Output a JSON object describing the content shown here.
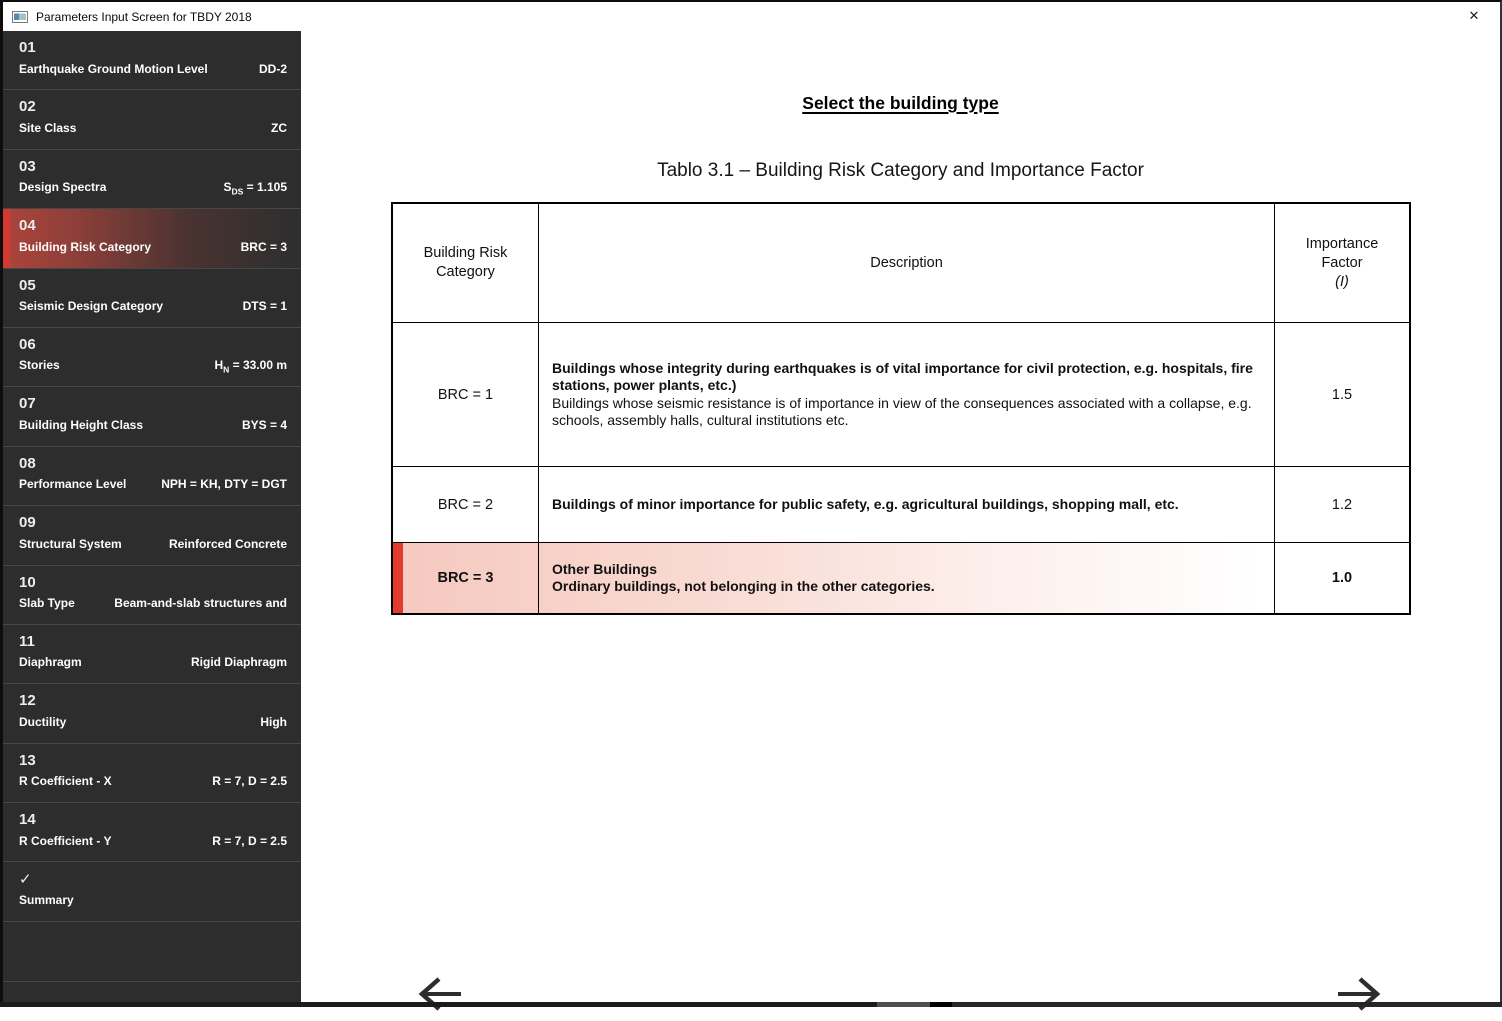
{
  "window": {
    "title": "Parameters Input Screen for TBDY 2018"
  },
  "sidebar": {
    "items": [
      {
        "number": "01",
        "label": "Earthquake Ground Motion Level",
        "value": "DD-2"
      },
      {
        "number": "02",
        "label": "Site Class",
        "value": "ZC"
      },
      {
        "number": "03",
        "label": "Design Spectra",
        "value_prefix": "S",
        "value_sub": "DS",
        "value_suffix": " = 1.105"
      },
      {
        "number": "04",
        "label": "Building Risk Category",
        "value": "BRC = 3",
        "selected": true
      },
      {
        "number": "05",
        "label": "Seismic Design Category",
        "value": "DTS = 1"
      },
      {
        "number": "06",
        "label": "Stories",
        "value_prefix": "H",
        "value_sub": "N",
        "value_suffix": " = 33.00 m"
      },
      {
        "number": "07",
        "label": "Building Height Class",
        "value": "BYS = 4"
      },
      {
        "number": "08",
        "label": "Performance Level",
        "value": "NPH = KH, DTY = DGT"
      },
      {
        "number": "09",
        "label": "Structural System",
        "value": "Reinforced Concrete"
      },
      {
        "number": "10",
        "label": "Slab Type",
        "value": "Beam-and-slab structures and"
      },
      {
        "number": "11",
        "label": "Diaphragm",
        "value": "Rigid Diaphragm"
      },
      {
        "number": "12",
        "label": "Ductility",
        "value": "High"
      },
      {
        "number": "13",
        "label": "R Coefficient - X",
        "value": "R = 7, D = 2.5"
      },
      {
        "number": "14",
        "label": "R Coefficient - Y",
        "value": "R = 7, D = 2.5"
      },
      {
        "number": "✓",
        "label": "Summary",
        "value": ""
      }
    ]
  },
  "main": {
    "heading": "Select the building type",
    "table_caption": "Tablo 3.1 – Building Risk Category and Importance Factor",
    "table": {
      "header": {
        "col_category": "Building Risk Category",
        "col_description": "Description",
        "col_factor_line1": "Importance",
        "col_factor_line2": "Factor",
        "col_factor_line3": "(I)"
      },
      "rows": [
        {
          "category": "BRC = 1",
          "desc_bold": "Buildings whose integrity during earthquakes is of vital importance for civil protection, e.g. hospitals, fire stations, power plants, etc.)",
          "desc_normal": "Buildings whose seismic resistance is of importance in view of the consequences associated with a collapse, e.g. schools, assembly halls, cultural institutions etc.",
          "factor": "1.5"
        },
        {
          "category": "BRC = 2",
          "desc_bold": "Buildings of minor importance for public safety, e.g. agricultural buildings, shopping mall, etc.",
          "factor": "1.2"
        },
        {
          "category": "BRC = 3",
          "desc_bold": "Other Buildings",
          "desc_bold_line2": "Ordinary buildings, not belonging in the other categories.",
          "factor": "1.0",
          "selected": true
        }
      ]
    }
  },
  "colors": {
    "sidebar_bg": "#2d2d2d",
    "accent_red": "#d23a30",
    "selected_row_accent": "#e23b2e",
    "selected_row_pink": "#f6c9bf"
  }
}
